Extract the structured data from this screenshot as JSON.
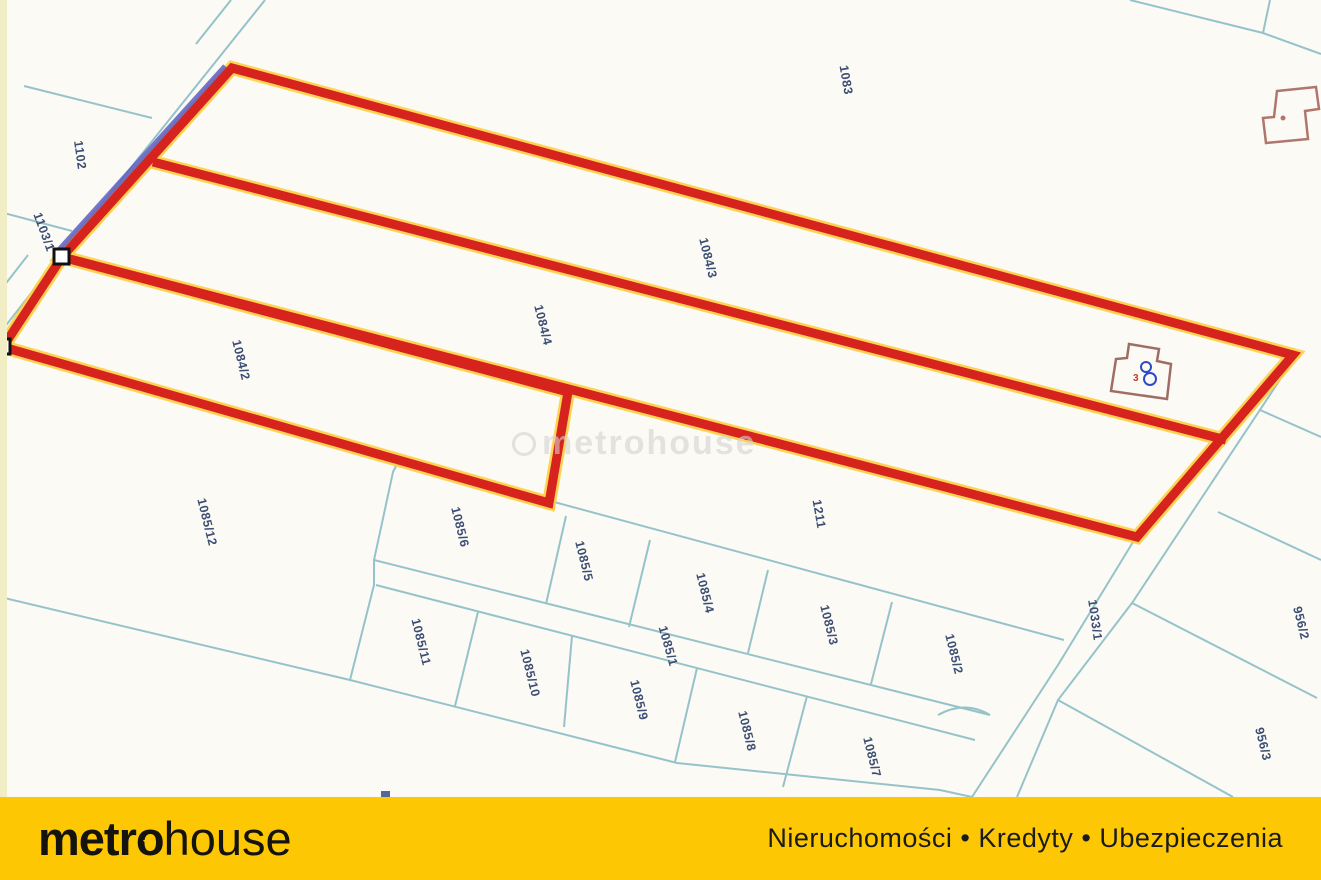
{
  "map": {
    "watermark_text": "metrohouse",
    "building_label": "3",
    "colors": {
      "selected_outline": "#d7231e",
      "selection_highlight": "#ffcf43",
      "boundary_line": "#96c3c9",
      "label_text": "#3d4e74"
    },
    "parcel_labels": [
      {
        "id": "1102",
        "x": 80,
        "y": 155,
        "rot": 82
      },
      {
        "id": "1103/1",
        "x": 44,
        "y": 232,
        "rot": 70
      },
      {
        "id": "1083",
        "x": 846,
        "y": 80,
        "rot": 80
      },
      {
        "id": "1084/3",
        "x": 708,
        "y": 258,
        "rot": 76
      },
      {
        "id": "1084/4",
        "x": 543,
        "y": 325,
        "rot": 76
      },
      {
        "id": "1084/2",
        "x": 241,
        "y": 360,
        "rot": 76
      },
      {
        "id": "1085/12",
        "x": 207,
        "y": 522,
        "rot": 76
      },
      {
        "id": "1085/6",
        "x": 460,
        "y": 527,
        "rot": 76
      },
      {
        "id": "1085/5",
        "x": 584,
        "y": 561,
        "rot": 76
      },
      {
        "id": "1085/4",
        "x": 705,
        "y": 593,
        "rot": 76
      },
      {
        "id": "1085/3",
        "x": 829,
        "y": 625,
        "rot": 76
      },
      {
        "id": "1085/2",
        "x": 954,
        "y": 654,
        "rot": 76
      },
      {
        "id": "1085/1",
        "x": 668,
        "y": 646,
        "rot": 74
      },
      {
        "id": "1085/11",
        "x": 421,
        "y": 642,
        "rot": 76
      },
      {
        "id": "1085/10",
        "x": 530,
        "y": 673,
        "rot": 76
      },
      {
        "id": "1085/9",
        "x": 639,
        "y": 700,
        "rot": 76
      },
      {
        "id": "1085/8",
        "x": 747,
        "y": 731,
        "rot": 76
      },
      {
        "id": "1085/7",
        "x": 872,
        "y": 757,
        "rot": 76
      },
      {
        "id": "1211",
        "x": 819,
        "y": 514,
        "rot": 80
      },
      {
        "id": "1033/1",
        "x": 1095,
        "y": 620,
        "rot": 82
      },
      {
        "id": "956/2",
        "x": 1301,
        "y": 623,
        "rot": 76
      },
      {
        "id": "956/3",
        "x": 1263,
        "y": 744,
        "rot": 76
      }
    ]
  },
  "footer": {
    "logo_metro": "metr",
    "logo_o": "o",
    "logo_house": "house",
    "tagline": "Nieruchomości • Kredyty • Ubezpieczenia",
    "background": "#fdc803"
  }
}
